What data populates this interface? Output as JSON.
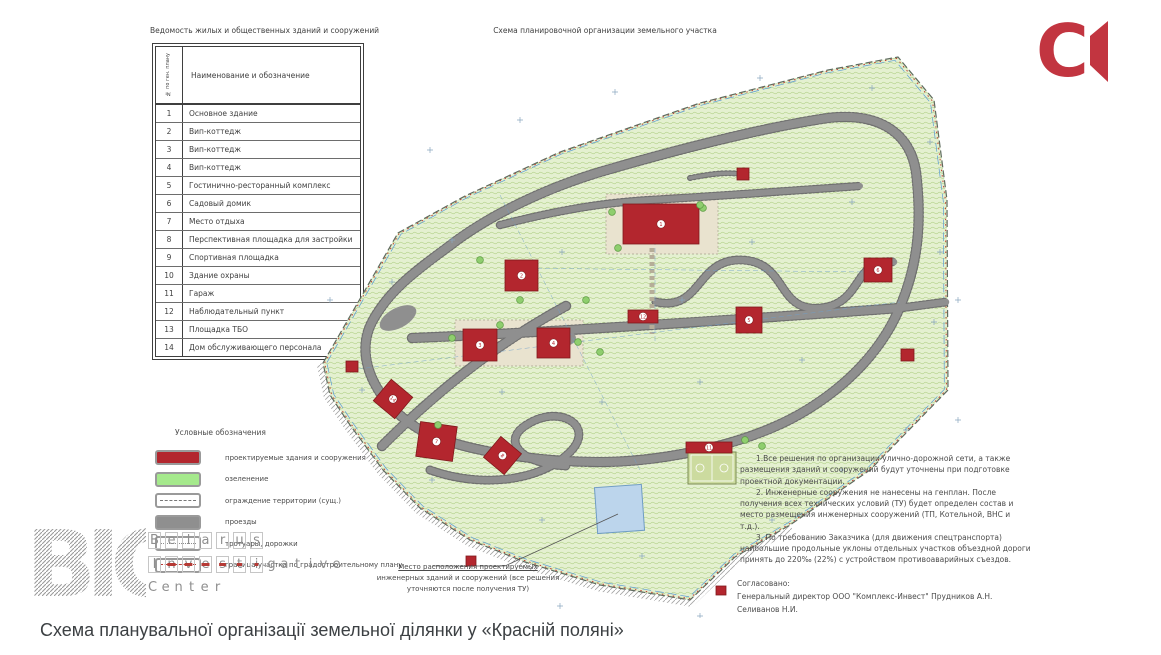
{
  "page": {
    "caption": "Схема планувальної організації земельної ділянки у «Красній поляні»"
  },
  "logo": {
    "letter": "C"
  },
  "sheet": {
    "table_title": "Ведомость жилых и общественных зданий и сооружений",
    "map_title": "Схема планировочной организации земельного участка",
    "table": {
      "col_num_header": "№ по ген. плану",
      "col_name_header": "Наименование и обозначение",
      "rows": [
        {
          "num": "1",
          "name": "Основное здание"
        },
        {
          "num": "2",
          "name": "Вип-коттедж"
        },
        {
          "num": "3",
          "name": "Вип-коттедж"
        },
        {
          "num": "4",
          "name": "Вип-коттедж"
        },
        {
          "num": "5",
          "name": "Гостинично-ресторанный комплекс"
        },
        {
          "num": "6",
          "name": "Садовый домик"
        },
        {
          "num": "7",
          "name": "Место отдыха"
        },
        {
          "num": "8",
          "name": "Перспективная площадка для застройки"
        },
        {
          "num": "9",
          "name": "Спортивная площадка"
        },
        {
          "num": "10",
          "name": "Здание охраны"
        },
        {
          "num": "11",
          "name": "Гараж"
        },
        {
          "num": "12",
          "name": "Наблюдательный пункт"
        },
        {
          "num": "13",
          "name": "Площадка ТБО"
        },
        {
          "num": "14",
          "name": "Дом обслуживающего персонала"
        }
      ]
    },
    "legend": {
      "title": "Условные обозначения",
      "items": [
        {
          "label": "проектируемые здания и сооружения",
          "type": "red"
        },
        {
          "label": "озеленение",
          "type": "green"
        },
        {
          "label": "ограждение территории (сущ.)",
          "type": "fence"
        },
        {
          "label": "проезды",
          "type": "gray"
        },
        {
          "label": "тротуары, дорожки",
          "type": "walk"
        },
        {
          "label": "граница участка по градостроительному плану",
          "type": "bound"
        }
      ]
    },
    "annotation": "Место расположения проектируемых\nинженерных зданий и сооружений (все решения\nуточняются после получения ТУ)",
    "notes": [
      "1.Все решения по организации улично-дорожной сети, а также размещения зданий и сооружений будут уточнены при подготовке проектной документации.",
      "2. Инженерные сооружения не нанесены на генплан. После получения всех технических условий (ТУ) будет определен состав и место размещения инженерных сооружений (ТП, Котельной, ВНС и т.д.).",
      "3. По требованию Заказчика (для движения спецтранспорта) наибольшие продольные уклоны отдельных участков объездной дороги принять до 220‰ (22%) с устройством противоаварийных съездов."
    ],
    "approval": [
      "Согласовано:",
      "Генеральный директор ООО \"Комплекс-Инвест\"  Прудников А.Н.",
      "Селиванов Н.И."
    ]
  },
  "watermark": {
    "line1": "Belarus",
    "line2": "Investigative",
    "line3": "Center"
  },
  "map": {
    "colors": {
      "terrain": "#e4f0d0",
      "road": "#8f8f8f",
      "building": "#b3262e",
      "pond": "#bcd5ec",
      "boundary_blue": "#5b9bd5",
      "boundary_red": "#c24038",
      "logo_red": "#c23540"
    },
    "buildings": [
      {
        "n": "1",
        "x": 623,
        "y": 204,
        "w": 76,
        "h": 40,
        "r": 0
      },
      {
        "n": "",
        "x": 737,
        "y": 168,
        "w": 12,
        "h": 12,
        "r": 0
      },
      {
        "n": "2",
        "x": 505,
        "y": 260,
        "w": 33,
        "h": 31,
        "r": 0
      },
      {
        "n": "3",
        "x": 463,
        "y": 329,
        "w": 34,
        "h": 32,
        "r": 0
      },
      {
        "n": "4",
        "x": 537,
        "y": 328,
        "w": 33,
        "h": 30,
        "r": 0
      },
      {
        "n": "12",
        "x": 628,
        "y": 310,
        "w": 30,
        "h": 13,
        "r": 0
      },
      {
        "n": "5",
        "x": 736,
        "y": 307,
        "w": 26,
        "h": 26,
        "r": 0
      },
      {
        "n": "6",
        "x": 864,
        "y": 258,
        "w": 28,
        "h": 24,
        "r": 0
      },
      {
        "n": "14",
        "x": 379,
        "y": 385,
        "w": 28,
        "h": 28,
        "r": 40
      },
      {
        "n": "7",
        "x": 418,
        "y": 424,
        "w": 37,
        "h": 35,
        "r": 8
      },
      {
        "n": "8",
        "x": 489,
        "y": 442,
        "w": 27,
        "h": 27,
        "r": 40
      },
      {
        "n": "11",
        "x": 686,
        "y": 442,
        "w": 46,
        "h": 11,
        "r": 0
      },
      {
        "n": "",
        "x": 346,
        "y": 361,
        "w": 12,
        "h": 11,
        "r": 0
      },
      {
        "n": "",
        "x": 901,
        "y": 349,
        "w": 13,
        "h": 12,
        "r": 0
      },
      {
        "n": "",
        "x": 466,
        "y": 556,
        "w": 10,
        "h": 10,
        "r": 0
      },
      {
        "n": "",
        "x": 716,
        "y": 586,
        "w": 10,
        "h": 9,
        "r": 0
      }
    ]
  }
}
